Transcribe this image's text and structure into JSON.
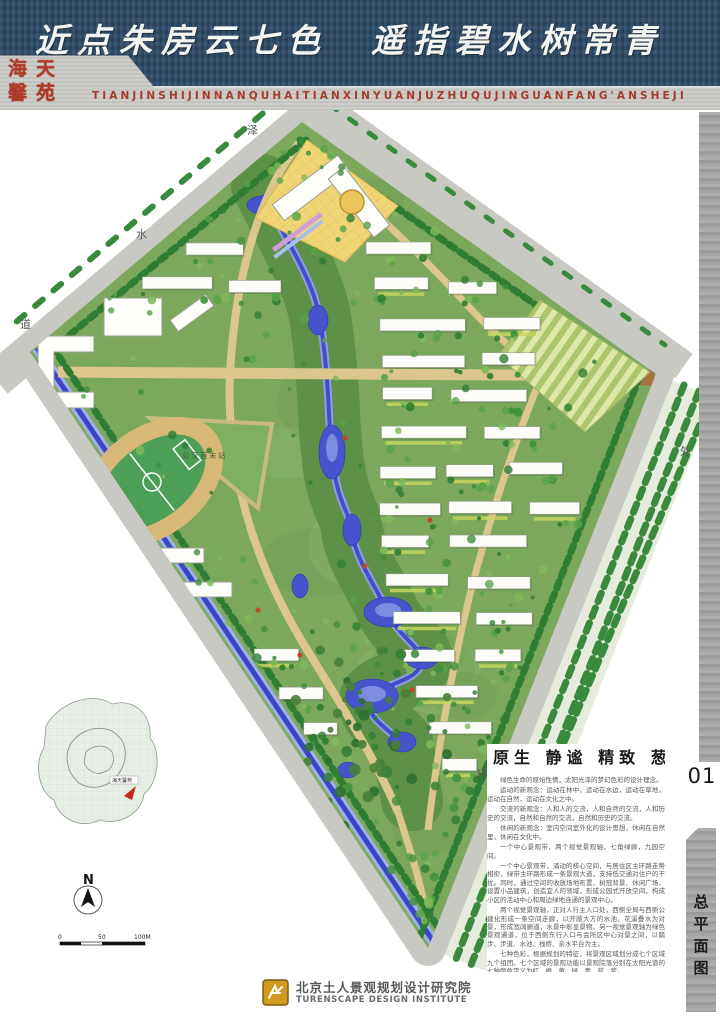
{
  "header": {
    "calligraphy_title": "近点朱房云七色　遥指碧水树常青",
    "seal_line1": "海天",
    "seal_line2": "馨苑",
    "pinyin_subtitle": "TIANJINSHIJINNANQUHAITIANXINYUANJUZHUQUJINGUANFANG'ANSHEJI"
  },
  "sidebar": {
    "page_number": "01",
    "tab_label": "总平面图"
  },
  "plan": {
    "road_labels": {
      "nw_1": "泽",
      "nw_2": "水",
      "nw_3": "道",
      "se_1": "外",
      "se_2": "环"
    },
    "site_labels": {
      "bus_terminus": "公交首末站"
    },
    "inset_label": "海天馨苑",
    "north_label": "N",
    "scale_ticks": [
      "0",
      "50",
      "100M"
    ],
    "colors": {
      "banner_blue": "#31506e",
      "band_gray": "#c6c6c2",
      "seal_red": "#b13a28",
      "site_green": "#7ca85e",
      "water_blue": "#4553cd",
      "canal_blue": "#3b46c6",
      "road_gray": "#c9c9c4",
      "path_tan": "#dcc68e",
      "axis_brown": "#aa7140",
      "plaza_yellow": "#f1d678",
      "tree_green": "#2f7d33"
    }
  },
  "description": {
    "title": "原生 静谧 精致 葱郁",
    "paragraphs": [
      "绿色生命的原始性情，太阳光泽的梦幻色彩的设计理念。",
      "运动的新观念：运动在林中，运动在水边，运动在草地，运动在自然，运动在文化之中。",
      "交流的新观念：人和人的交流，人和自然的交流，人和历史的交流，自然和自然的交流，自然和历史的交流。",
      "休闲的新观念：室内空间室外化的设计思想，休闲在自然里，休闲在文化中。",
      "一个中心景观带，两个视觉景观轴，七角绿廊，九园空间。",
      "一个中心景观带，涌动的核心空间，与居住区主环路走势相衔，绿带主环路形成一条景观大道，支持低交通对住户的干扰。同时，通过空间的收放场地布置、树冠背景、休闲广场、设置小品建筑，创造宜人的领域，形成公园式开放空间，构成小区的活动中心和周边绿地连通的景观中心。",
      "两个视觉景观轴，正对人行主入口处，西侧全局与西侧公建化形成一条空间走廊，以开敞大方的水池、花溪叠水为对景，形成宽阔廊道，水景中彰显景物。另一视觉景观轴为绿色景观通道，位于西侧东行入口与会所区中心对景之间，以踏步、步道、水池、栈桥、亲水平台为主。",
      "七种色彩，根据规划的特征，将景观区域划分成七个区域九个组团。七个区域的景观功能以景观院落分别在太阳光谱的七种颜色定义为红、橙、黄、绿、青、蓝、紫。",
      "九园空间，由小区内道路自然分割而成，根据其主题风格的不同各组团拥有不同的特色命名。每组团都有自己的相对独立和私密的活动空间，同时各空间会有景廊相连，步移景异。"
    ]
  },
  "footer": {
    "institute_cn": "北京土人景观规划设计研究院",
    "institute_en": "TURENSCAPE DESIGN INSTITUTE"
  }
}
